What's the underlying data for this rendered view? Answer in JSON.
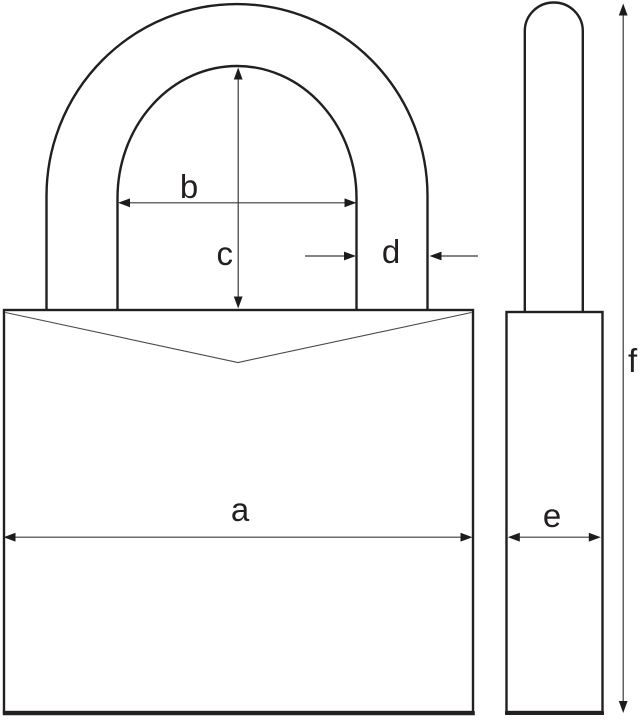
{
  "diagram": {
    "title": "Padlock dimension drawing",
    "views": {
      "front": "padlock front view",
      "side": "padlock side view"
    },
    "labels": {
      "a": "a",
      "b": "b",
      "c": "c",
      "d": "d",
      "e": "e",
      "f": "f"
    },
    "colors": {
      "background": "#ffffff",
      "outline": "#231f20",
      "dimension_line": "#3a3a3a",
      "arrowhead": "#1c1c1c",
      "notch_line": "#4a4a4a"
    }
  }
}
